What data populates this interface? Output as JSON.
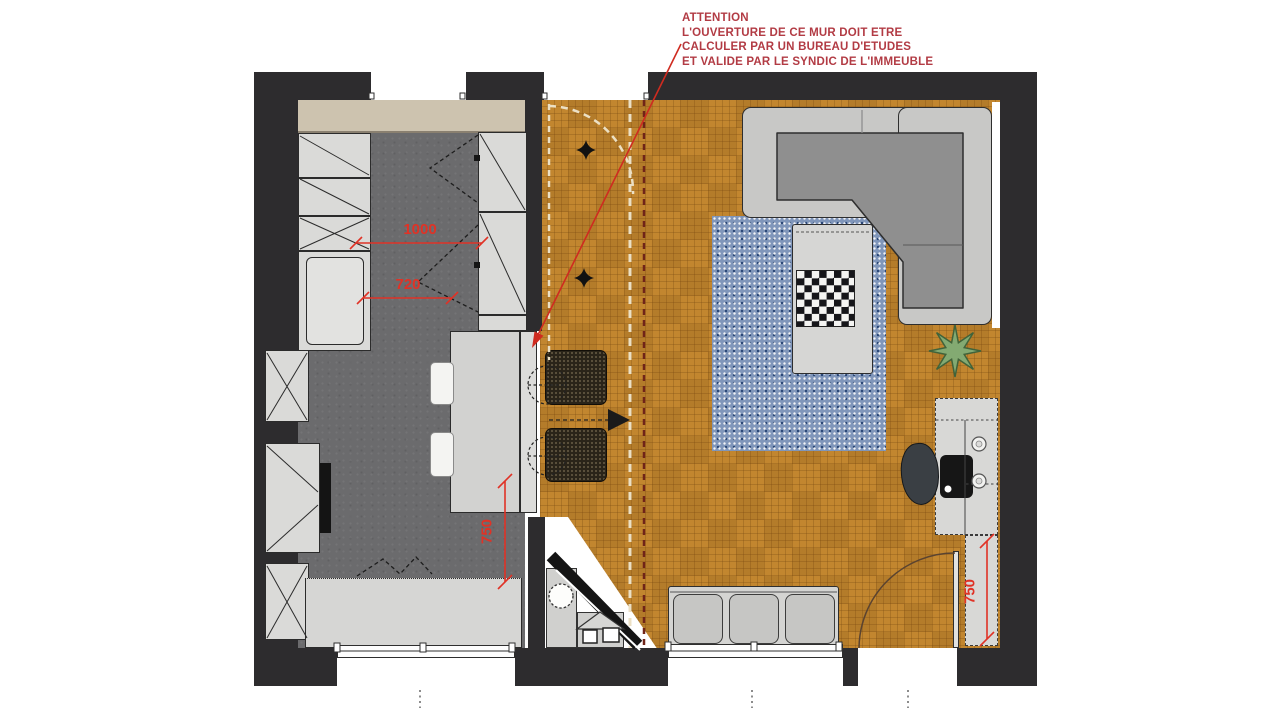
{
  "annotation": {
    "lines": [
      "ATTENTION",
      "L'OUVERTURE DE CE MUR DOIT ETRE",
      "CALCULER PAR UN BUREAU D'ETUDES",
      "ET VALIDE PAR LE SYNDIC DE L'IMMEUBLE"
    ]
  },
  "dimensions": {
    "kitchen_clearance": "1000",
    "kitchen_passage": "720",
    "kitchen_counter_depth": "750",
    "desk_counter_depth": "750"
  },
  "icons": {
    "sparkle_light": "ceiling-light sparkle marker",
    "plant": "potted plant star",
    "shrub": "entry shrub symbol",
    "chessboard": "chess board on coffee table",
    "view_arrow": "view-direction triangle marker",
    "leader_arrow": "red leader arrow to wall opening"
  },
  "colors": {
    "wall": "#2d2c2e",
    "wood_floor": "#c2862f",
    "kitchen_floor": "#6b6b6d",
    "cabinet": "#dadad8",
    "upper_cabinet_beige": "#cdc3af",
    "rug": "#8096ba",
    "sofa_shell": "#c8c8c6",
    "sofa_seat": "#8f8f8f",
    "dimension_red": "#e03226",
    "annotation_red": "#b23b44"
  }
}
